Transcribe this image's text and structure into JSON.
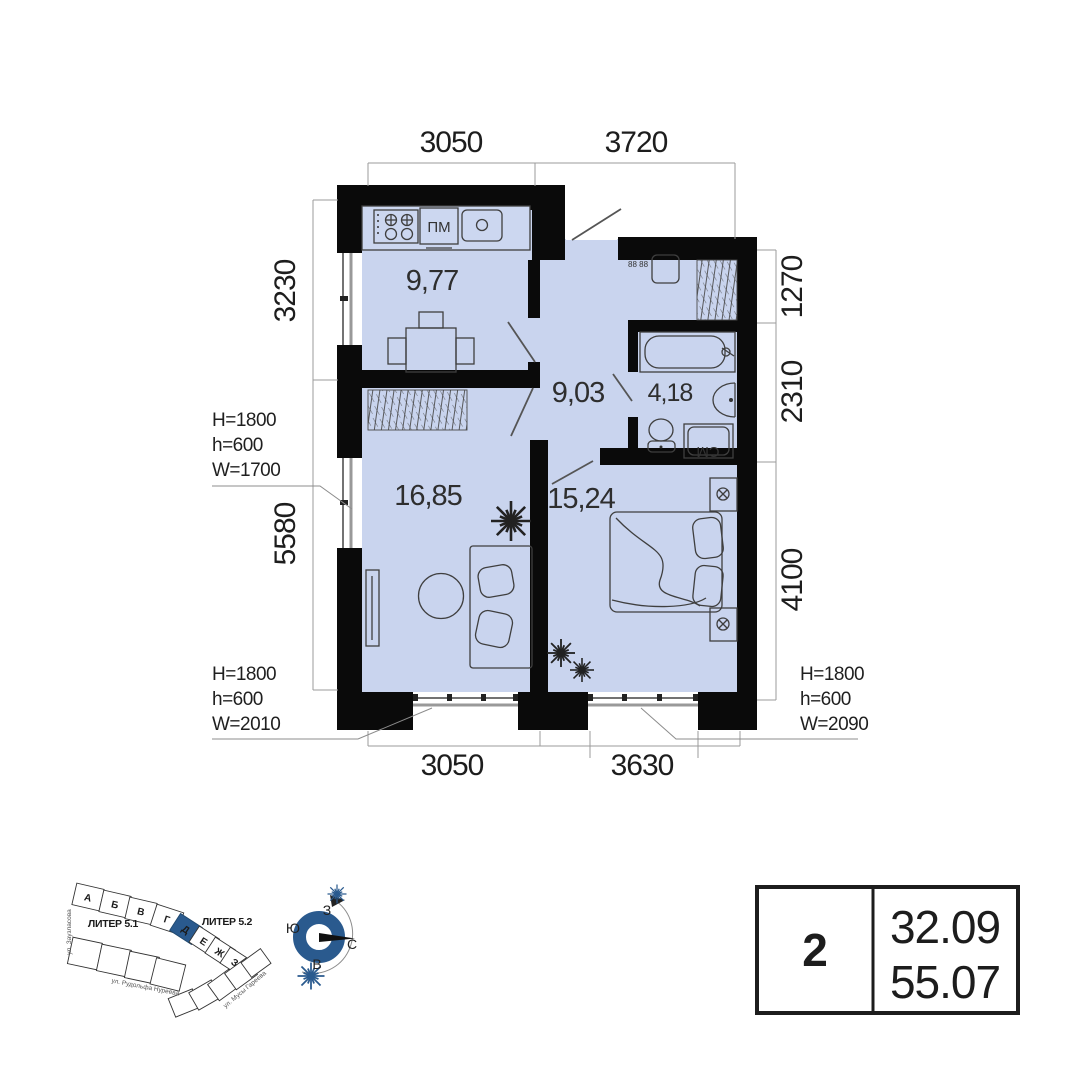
{
  "plan": {
    "dims": {
      "top": [
        "3050",
        "3720"
      ],
      "left": [
        "3230",
        "5580"
      ],
      "right": [
        "1270",
        "2310",
        "4100"
      ],
      "bottom": [
        "3050",
        "3630"
      ]
    },
    "areas": {
      "kitchen": "9,77",
      "hall": "9,03",
      "bath": "4,18",
      "living": "16,85",
      "bedroom": "15,24"
    },
    "window_annotations": {
      "left": [
        "H=1800",
        "h=600",
        "W=1700"
      ],
      "bottom_left": [
        "H=1800",
        "h=600",
        "W=2010"
      ],
      "bottom_right": [
        "H=1800",
        "h=600",
        "W=2090"
      ]
    },
    "labels": {
      "dishwasher": "ПМ",
      "washer": "СМ",
      "meter": "88 88"
    }
  },
  "site_plan": {
    "liter_left": "ЛИТЕР 5.1",
    "liter_right": "ЛИТЕР 5.2",
    "sections": [
      "А",
      "Б",
      "В",
      "Г",
      "Д",
      "Е",
      "Ж",
      "З"
    ],
    "highlighted_section": "Д",
    "streets": {
      "left": "ул. Заузласова",
      "bottom": "ул. Рудольфа Нуреева",
      "right": "ул. Мусы Гареева"
    }
  },
  "compass": {
    "west": "З",
    "south": "Ю",
    "north": "С",
    "east": "В"
  },
  "info_table": {
    "rooms": "2",
    "area_living": "32.09",
    "area_total": "55.07"
  },
  "colors": {
    "room_fill": "#c9d4ee",
    "wall": "#0a0a0a",
    "accent_blue": "#2a5a8e"
  }
}
